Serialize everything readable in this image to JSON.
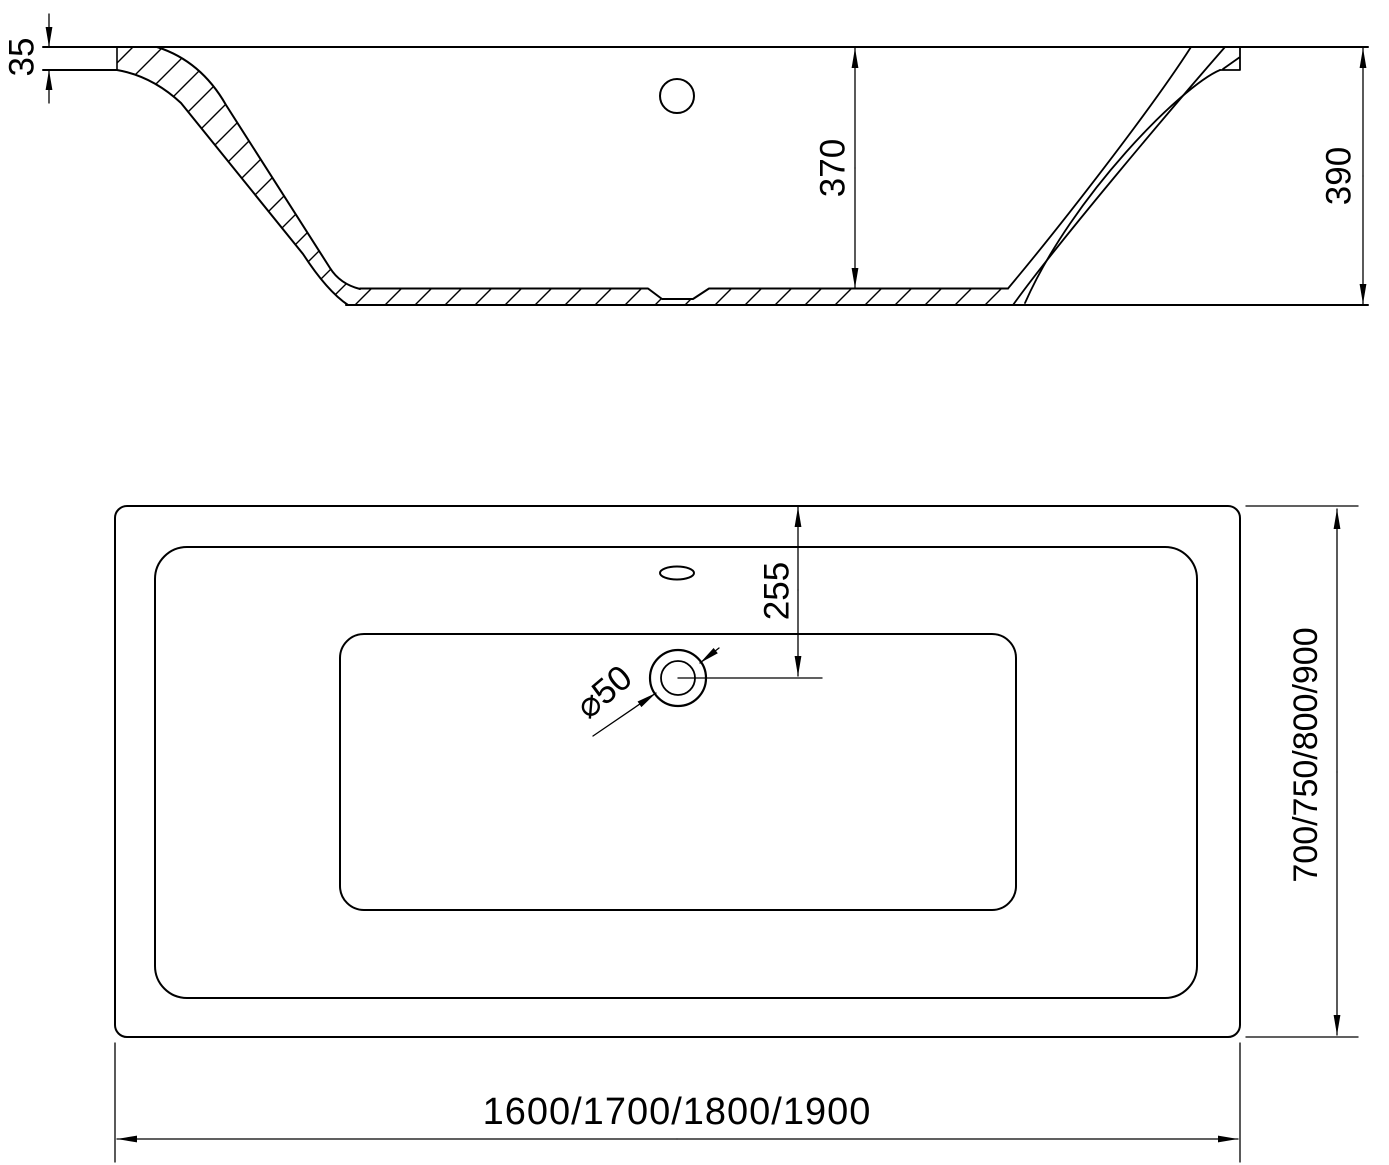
{
  "drawing": {
    "type": "technical-dimension-drawing",
    "subject": "bathtub",
    "colors": {
      "line": "#000000",
      "background": "#ffffff"
    },
    "section_view": {
      "labels": {
        "rim_thickness": "35",
        "inner_depth": "370",
        "overall_height": "390"
      }
    },
    "plan_view": {
      "labels": {
        "drain_offset": "255",
        "drain_diameter": "⌀50",
        "width_variants": "700/750/800/900",
        "length_variants": "1600/1700/1800/1900"
      }
    }
  }
}
